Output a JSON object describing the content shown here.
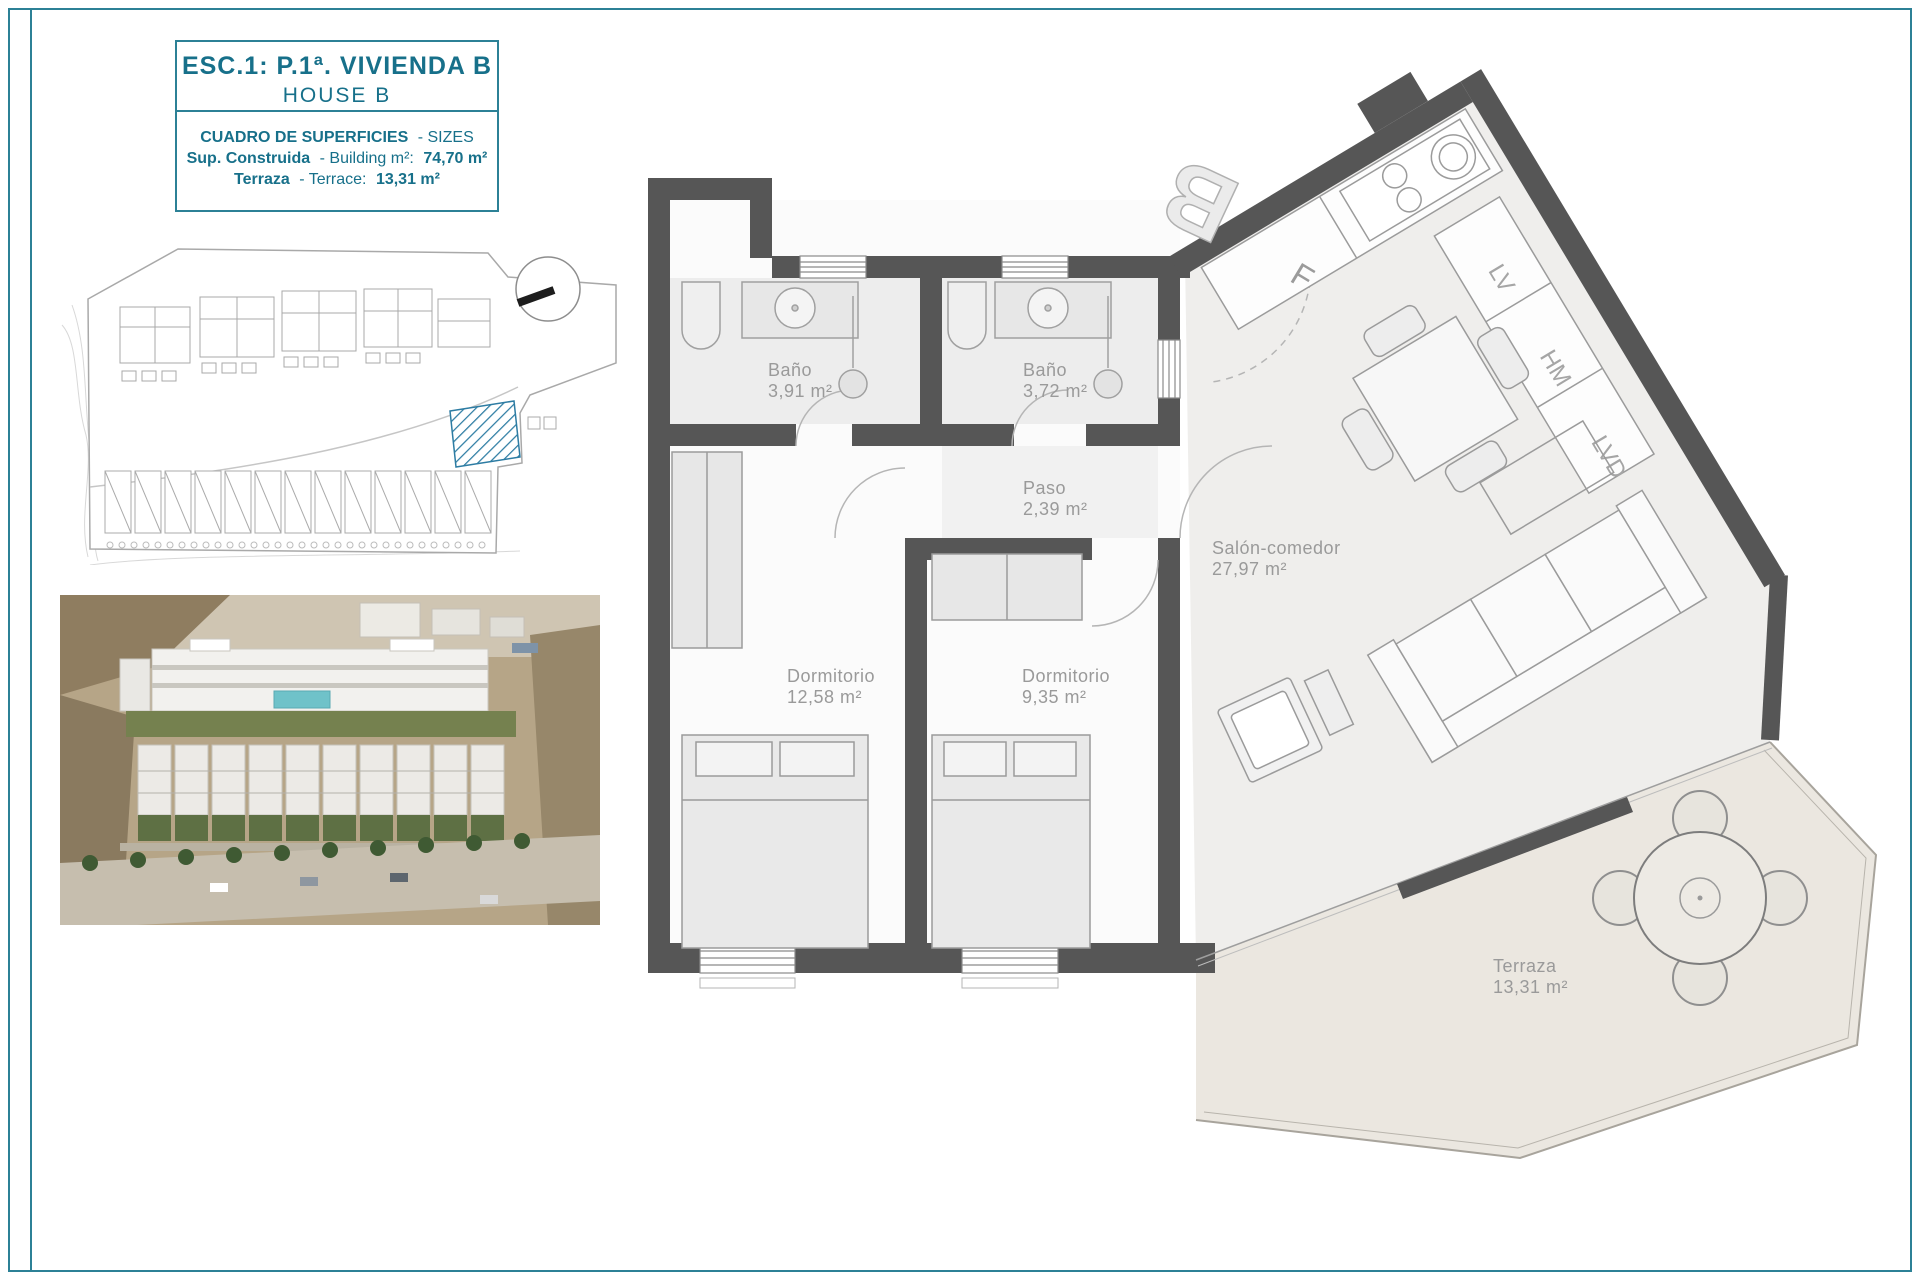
{
  "sheet": {
    "title": "ESC.1: P.1ª. VIVIENDA B",
    "subtitle": "HOUSE B",
    "sizes": {
      "header_bold": "CUADRO DE SUPERFICIES",
      "header_light": "- SIZES",
      "rows": [
        {
          "bold": "Sup. Construida",
          "light": "- Building m²:",
          "value": "74,70 m²"
        },
        {
          "bold": "Terraza",
          "light": "- Terrace:",
          "value": "13,31 m²"
        }
      ]
    }
  },
  "floor_plan": {
    "rooms": [
      {
        "name": "Baño",
        "area": "3,91 m²"
      },
      {
        "name": "Baño",
        "area": "3,72 m²"
      },
      {
        "name": "Paso",
        "area": "2,39 m²"
      },
      {
        "name": "Dormitorio",
        "area": "12,58 m²"
      },
      {
        "name": "Dormitorio",
        "area": "9,35 m²"
      },
      {
        "name": "Salón-comedor",
        "area": "27,97 m²"
      },
      {
        "name": "Terraza",
        "area": "13,31 m²"
      }
    ],
    "unit_letter": "B",
    "fridge_label": "F",
    "appliance_labels": [
      "LV",
      "HM",
      "LVD"
    ]
  },
  "colors": {
    "teal_text": "#17708a",
    "frame": "#2c8196",
    "wall": "#565656",
    "label_gray": "#9a9a9a",
    "highlight_blue": "#2d7ca3"
  }
}
